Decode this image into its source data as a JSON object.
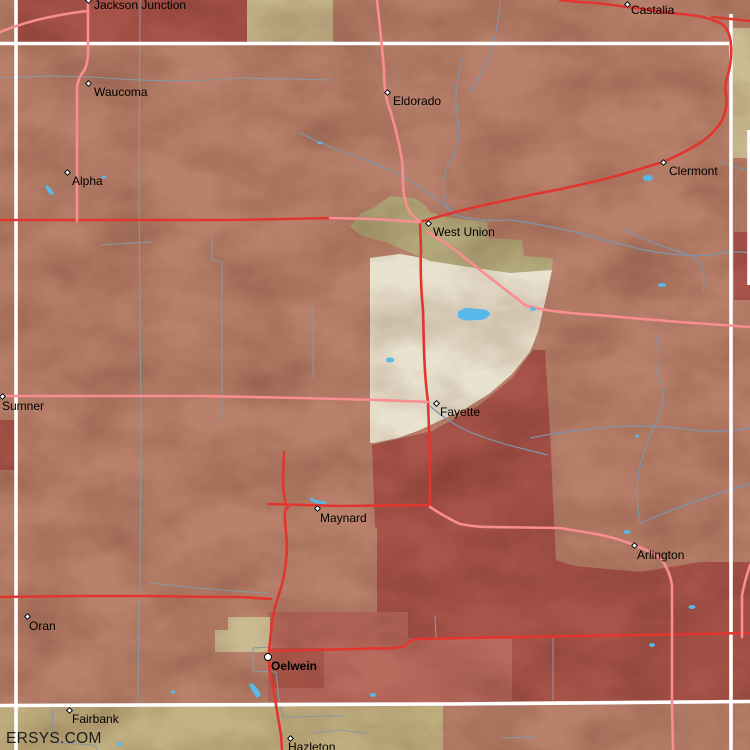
{
  "site": {
    "watermark": "ERSYS.COM"
  },
  "map": {
    "towns": [
      {
        "id": "jackson-junction",
        "label": "Jackson Junction",
        "x": 88,
        "y": 0,
        "label_x": 94,
        "label_y": -1,
        "marker": "diamond",
        "bold": false
      },
      {
        "id": "castalia",
        "label": "Castalia",
        "x": 627,
        "y": 4,
        "label_x": 631,
        "label_y": 4,
        "marker": "diamond",
        "bold": false
      },
      {
        "id": "waucoma",
        "label": "Waucoma",
        "x": 88,
        "y": 83,
        "label_x": 94,
        "label_y": 86,
        "marker": "diamond",
        "bold": false
      },
      {
        "id": "eldorado",
        "label": "Eldorado",
        "x": 387,
        "y": 92,
        "label_x": 393,
        "label_y": 95,
        "marker": "diamond",
        "bold": false
      },
      {
        "id": "alpha",
        "label": "Alpha",
        "x": 67,
        "y": 172,
        "label_x": 72,
        "label_y": 175,
        "marker": "diamond",
        "bold": false
      },
      {
        "id": "clermont",
        "label": "Clermont",
        "x": 663,
        "y": 162,
        "label_x": 669,
        "label_y": 165,
        "marker": "diamond",
        "bold": false
      },
      {
        "id": "west-union",
        "label": "West Union",
        "x": 428,
        "y": 223,
        "label_x": 433,
        "label_y": 226,
        "marker": "diamond",
        "bold": false
      },
      {
        "id": "sumner",
        "label": "Sumner",
        "x": 2,
        "y": 396,
        "label_x": 2,
        "label_y": 400,
        "marker": "diamond",
        "bold": false
      },
      {
        "id": "fayette",
        "label": "Fayette",
        "x": 436,
        "y": 403,
        "label_x": 440,
        "label_y": 406,
        "marker": "diamond",
        "bold": false
      },
      {
        "id": "maynard",
        "label": "Maynard",
        "x": 317,
        "y": 508,
        "label_x": 320,
        "label_y": 512,
        "marker": "diamond",
        "bold": false
      },
      {
        "id": "arlington",
        "label": "Arlington",
        "x": 634,
        "y": 545,
        "label_x": 637,
        "label_y": 549,
        "marker": "diamond",
        "bold": false
      },
      {
        "id": "oran",
        "label": "Oran",
        "x": 27,
        "y": 616,
        "label_x": 29,
        "label_y": 620,
        "marker": "diamond",
        "bold": false
      },
      {
        "id": "oelwein",
        "label": "Oelwein",
        "x": 268,
        "y": 657,
        "label_x": 271,
        "label_y": 660,
        "marker": "circle",
        "bold": true
      },
      {
        "id": "fairbank",
        "label": "Fairbank",
        "x": 69,
        "y": 710,
        "label_x": 72,
        "label_y": 713,
        "marker": "diamond",
        "bold": false
      },
      {
        "id": "hazleton",
        "label": "Hazleton",
        "x": 290,
        "y": 738,
        "label_x": 288,
        "label_y": 741,
        "marker": "diamond",
        "bold": false
      }
    ],
    "colors": {
      "terrain": "#b9816b",
      "county_line": "#ffffff",
      "road_highway": "#e3352f",
      "road_secondary": "#f98d91",
      "boundary_minor": "#8a97a0",
      "stream": "#7d95ab",
      "water": "#58b8ea",
      "region_dark_red": "#a9544a",
      "region_medium_red": "#b96b5e",
      "region_core_red": "#ad594c",
      "region_khaki": "#b3a87a",
      "region_cream": "#e9e2cf",
      "region_tan": "#cbbc92",
      "region_bottom_tan": "#c2b181",
      "label_text": "#000000"
    }
  }
}
